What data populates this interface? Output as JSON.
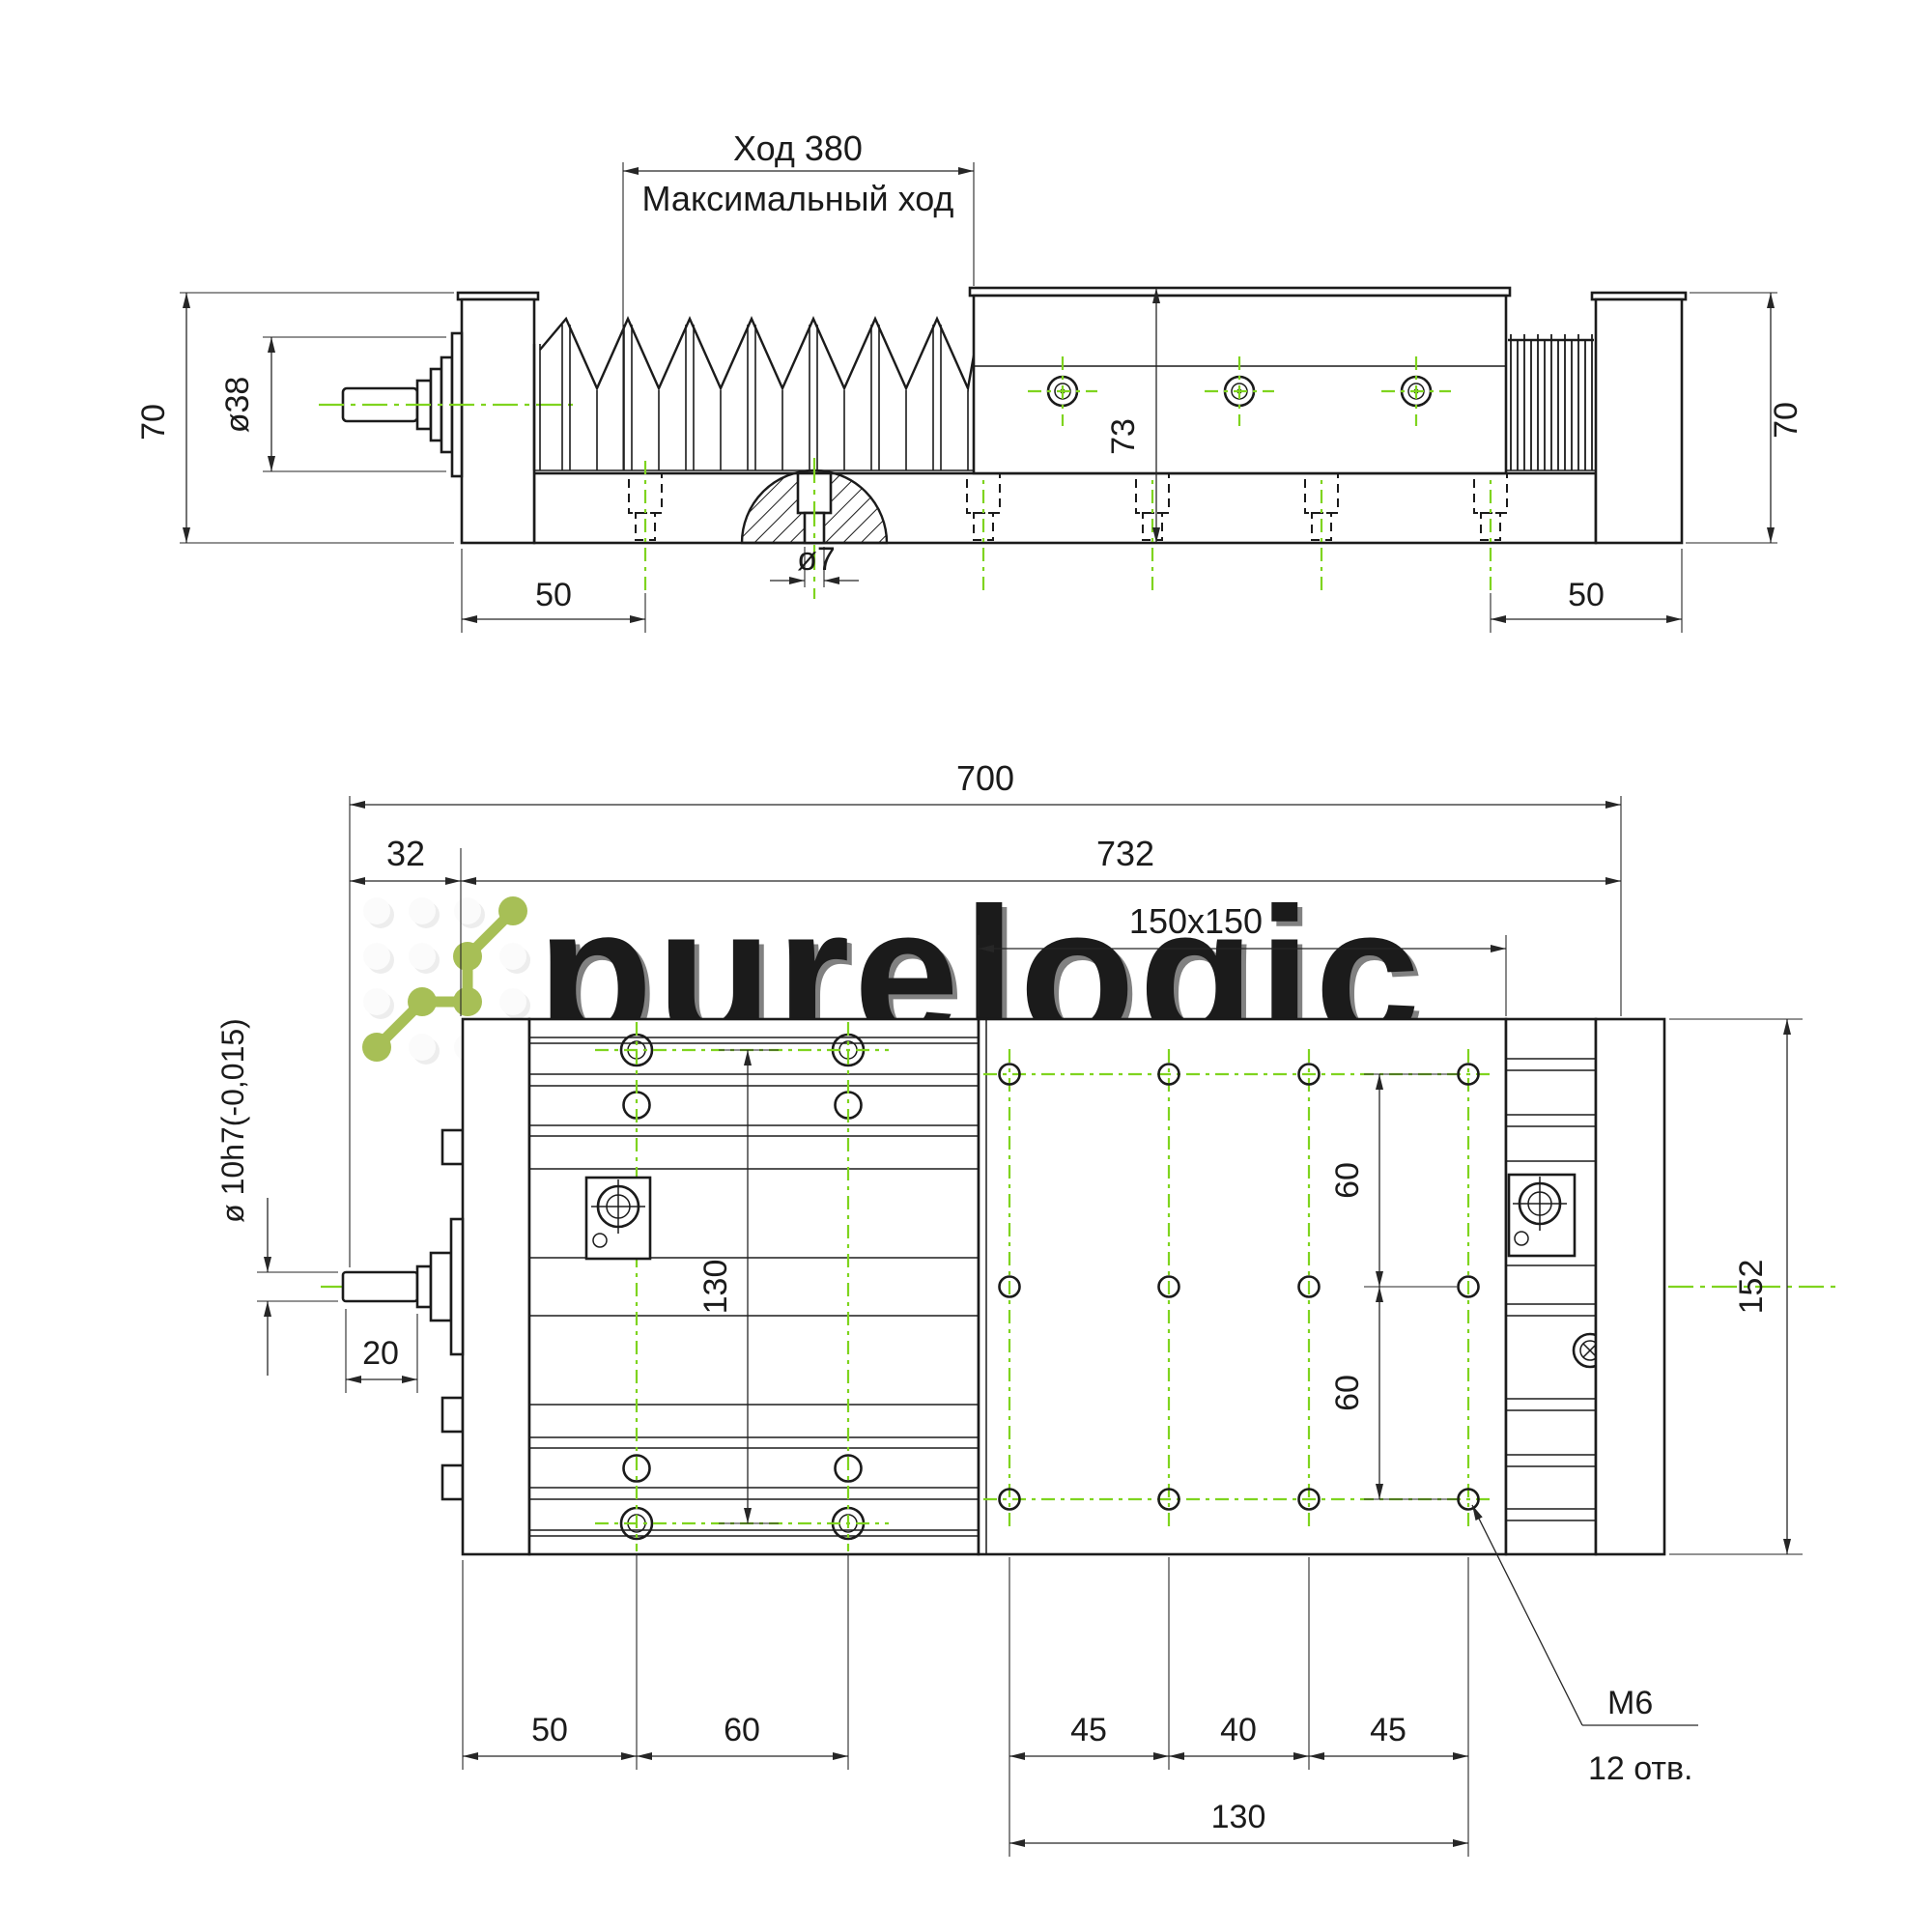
{
  "colors": {
    "centerline_green": "#7fd41f",
    "logo_green": "#a7bf56",
    "line_dark": "#1b1b1b",
    "watermark_gray": "#f1f1f1",
    "plate_dim_gray": "#8f9595"
  },
  "watermark": {
    "brand": "purelogic",
    "tagline": "research & development"
  },
  "top_view": {
    "stroke_label": "Ход 380",
    "stroke_sublabel": "Максимальный ход",
    "dim_height_left": "70",
    "dim_shaft_dia": "ø38",
    "dim_base_hole_offset_left": "50",
    "dim_hole_dia": "ø7",
    "dim_carriage_height": "73",
    "dim_base_hole_offset_right": "50",
    "dim_height_right": "70"
  },
  "bottom_view": {
    "dim_total_length": "700",
    "dim_motor_plate": "32",
    "dim_body_length": "732",
    "dim_plate_size": "150x150",
    "dim_shaft_dia": "ø 10h7(-0,015)",
    "dim_shaft_length": "20",
    "dim_base_hole_rows": "130",
    "dim_row_spacing_top": "60",
    "dim_row_spacing_bottom": "60",
    "dim_overall_width": "152",
    "dim_hole_offset": "50",
    "dim_hole_spacing": "60",
    "dim_col_spacing_1": "45",
    "dim_col_spacing_2": "40",
    "dim_col_spacing_3": "45",
    "dim_col_span": "130",
    "thread_label": "M6",
    "holes_count": "12 отв."
  }
}
